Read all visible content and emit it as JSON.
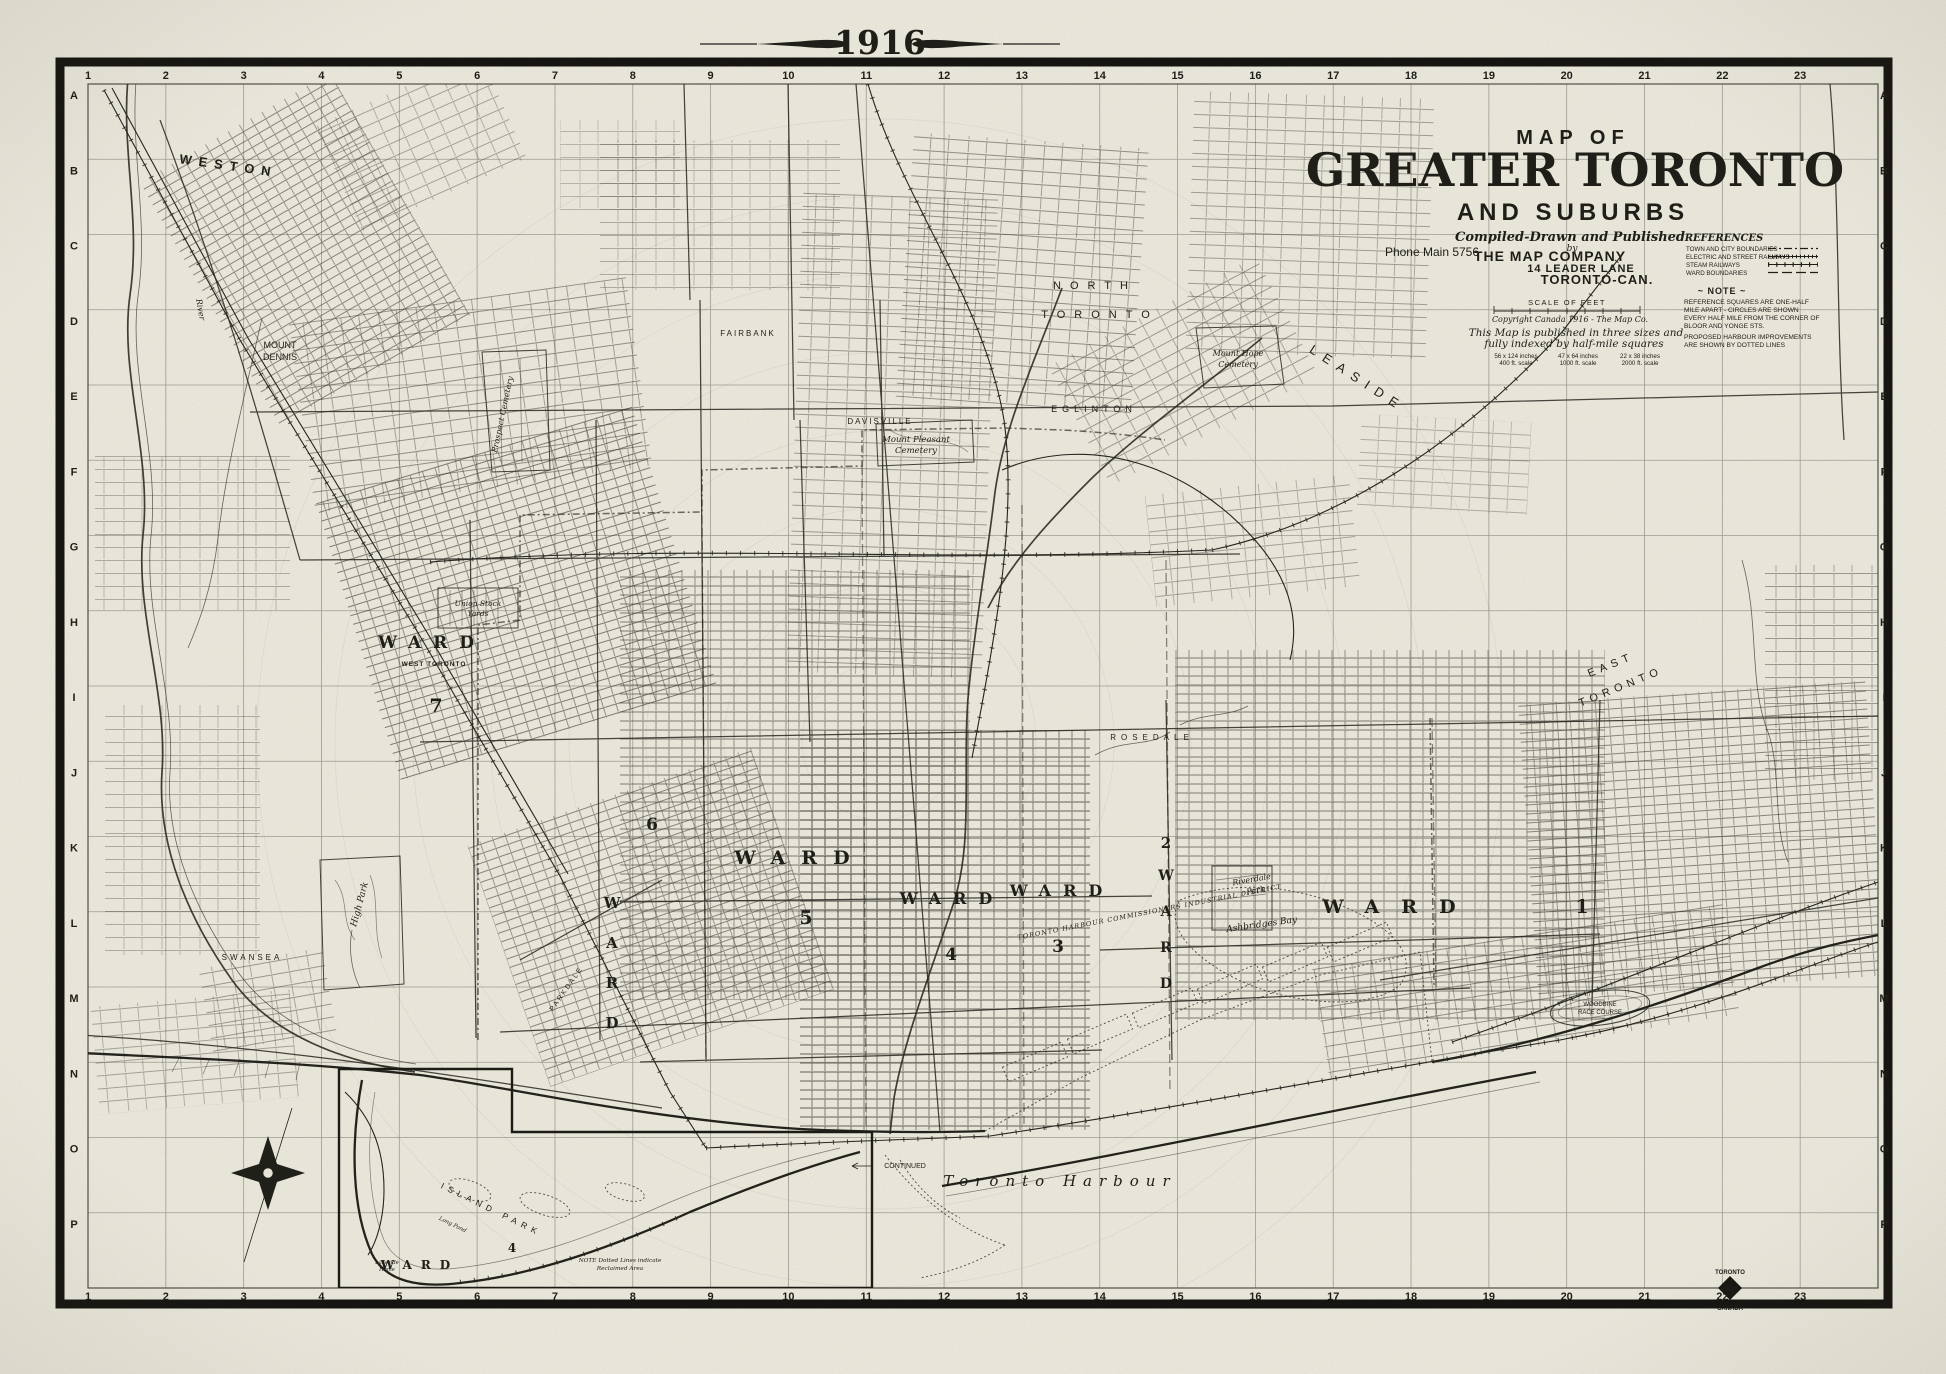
{
  "page": {
    "year": "1916"
  },
  "title_block": {
    "map_of": "MAP OF",
    "title": "GREATER TORONTO",
    "subtitle": "AND SUBURBS",
    "compiled": "Compiled-Drawn and Published",
    "by": "by",
    "company": "THE MAP COMPANY",
    "address": "14 LEADER LANE",
    "city": "TORONTO-CAN.",
    "phone": "Phone Main 5756",
    "scale_label": "SCALE OF FEET",
    "copyright": "Copyright Canada 1916 - The Map Co.",
    "published_1": "This Map is published in three sizes and",
    "published_2": "fully indexed by half-mile squares",
    "sizes": [
      {
        "size": "56 x 124 inches",
        "scale": "400 ft. scale"
      },
      {
        "size": "47 x 64 inches",
        "scale": "1000 ft. scale"
      },
      {
        "size": "22 x 38 inches",
        "scale": "2000 ft. scale"
      }
    ]
  },
  "references": {
    "title": "REFERENCES",
    "items": [
      {
        "label": "TOWN AND CITY BOUNDARIES"
      },
      {
        "label": "ELECTRIC AND STREET RAILWAYS"
      },
      {
        "label": "STEAM RAILWAYS"
      },
      {
        "label": "WARD BOUNDARIES"
      }
    ],
    "note_title": "~ NOTE ~",
    "note_lines": [
      "REFERENCE SQUARES ARE ONE-HALF",
      "MILE APART - CIRCLES ARE SHOWN",
      "EVERY HALF MILE FROM THE CORNER OF",
      "BLOOR AND YONGE STS.",
      "PROPOSED HARBOUR IMPROVEMENTS",
      "ARE SHOWN BY DOTTED LINES"
    ]
  },
  "grid": {
    "columns": [
      "1",
      "2",
      "3",
      "4",
      "5",
      "6",
      "7",
      "8",
      "9",
      "10",
      "11",
      "12",
      "13",
      "14",
      "15",
      "16",
      "17",
      "18",
      "19",
      "20",
      "21",
      "22",
      "23"
    ],
    "rows": [
      "A",
      "B",
      "C",
      "D",
      "E",
      "F",
      "G",
      "H",
      "I",
      "J",
      "K",
      "L",
      "M",
      "N",
      "O",
      "P"
    ]
  },
  "wards": {
    "w1": {
      "word": "WARD",
      "num": "1"
    },
    "w2": {
      "word": "WARD",
      "num": "2"
    },
    "w3": {
      "word": "WARD",
      "num": "3"
    },
    "w4": {
      "word": "WARD",
      "num": "4"
    },
    "w5": {
      "word": "WARD",
      "num": "5"
    },
    "w6": {
      "word": "WARD",
      "num": "6"
    },
    "w7": {
      "word": "WARD",
      "num": "7",
      "sub": "WEST TORONTO"
    }
  },
  "places": {
    "weston": "WESTON",
    "mount_dennis_1": "MOUNT",
    "mount_dennis_2": "DENNIS",
    "fairbank": "FAIRBANK",
    "north_toronto_1": "NORTH",
    "north_toronto_2": "TORONTO",
    "eglinton": "EGLINTON",
    "davisville": "DAVISVILLE",
    "leaside": "LEASIDE",
    "mt_pleasant_1": "Mount Pleasant",
    "mt_pleasant_2": "Cemetery",
    "mt_hope_1": "Mount Hope",
    "mt_hope_2": "Cemetery",
    "prospect": "Prospect Cemetery",
    "stock_1": "Union Stock",
    "stock_2": "Yards",
    "parkdale": "PARKDALE",
    "rosedale": "ROSEDALE",
    "riverdale_1": "Riverdale",
    "riverdale_2": "Park",
    "east_toronto_1": "EAST",
    "east_toronto_2": "TORONTO",
    "swansea": "SWANSEA",
    "high_park": "High Park",
    "river": "River",
    "harbour": "Toronto Harbour",
    "ashbridges": "Ashbridges Bay",
    "woodbine_1": "WOODBINE",
    "woodbine_2": "RACE COURSE",
    "industrial": "TORONTO HARBOUR COMMISSIONERS INDUSTRIAL DISTRICT",
    "continued": "CONTINUED"
  },
  "inset": {
    "island_park": "ISLAND PARK",
    "long_pond": "Long Pond",
    "ward_word": "WARD",
    "ward_num": "4",
    "lakeside_1": "Lakeside",
    "lakeside_2": "Home",
    "note_1": "NOTE  Dotted Lines indicate",
    "note_2": "Reclaimed Area"
  },
  "logo": {
    "top": "TORONTO",
    "mid": "MAP",
    "bottom": "CANADA"
  }
}
